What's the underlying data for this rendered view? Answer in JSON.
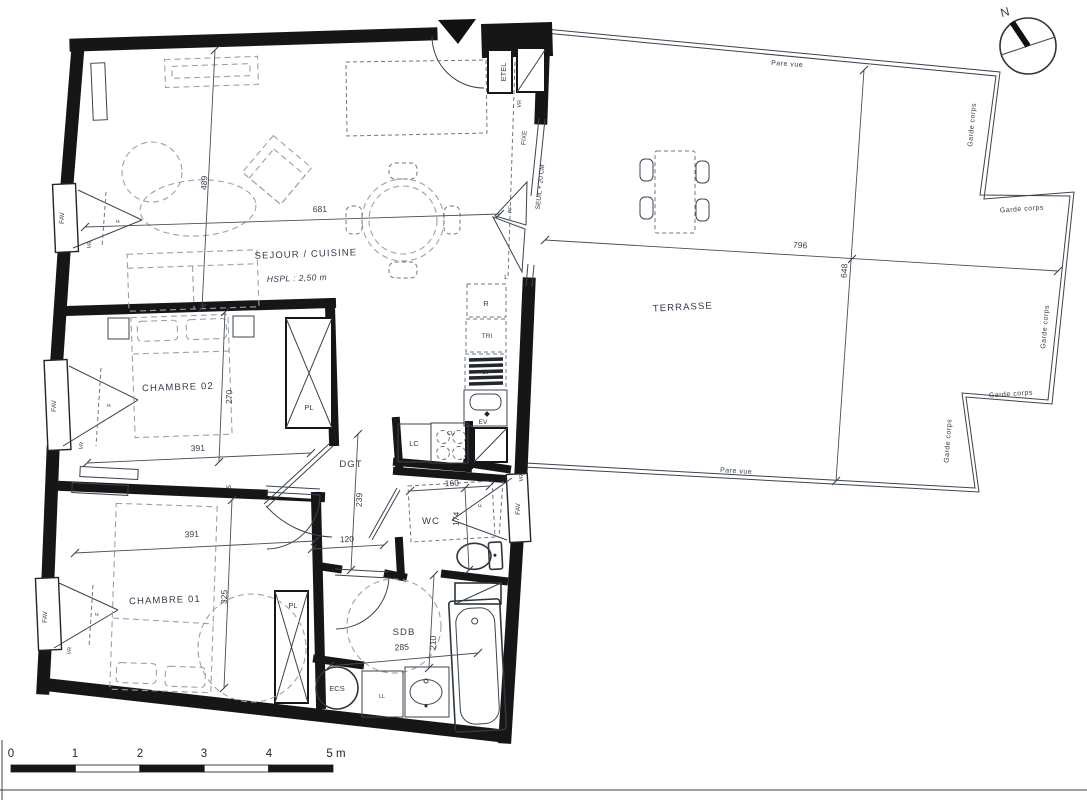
{
  "rooms": {
    "sejour": {
      "label": "SEJOUR / CUISINE",
      "hspl": "HSPL : 2,50 m"
    },
    "chambre02": {
      "label": "CHAMBRE 02"
    },
    "chambre01": {
      "label": "CHAMBRE 01"
    },
    "terrasse": {
      "label": "TERRASSE"
    },
    "dgt": {
      "label": "DGT"
    },
    "wc": {
      "label": "WC"
    },
    "sdb": {
      "label": "SDB"
    }
  },
  "fixtures": {
    "etel": "ETEL",
    "refrigerateur": "R",
    "tri": "TRI",
    "lave_vaisselle": "LV",
    "evier": "EV",
    "lave_linge_cuisine": "LC",
    "cuisson": "CU",
    "l": "L",
    "placard_haut": "PL",
    "placard_bas": "PL",
    "ecs": "ECS",
    "lave_linge": "LL"
  },
  "openings": {
    "fav": "FAV",
    "fixe": "FIXE",
    "pf": "PF",
    "vr": "VR",
    "f": "F",
    "seuil": "SEUIL + 20 CM"
  },
  "dimensions": {
    "sejour_longueur": "681",
    "sejour_largeur": "489",
    "chambre02_longueur": "391",
    "chambre02_largeur": "270",
    "chambre01_longueur": "391",
    "chambre01_largeur": "325",
    "cloison": "5",
    "dgt_longueur": "239",
    "dgt_largeur": "120",
    "wc_longueur": "160",
    "wc_largeur": "174",
    "sdb_longueur": "285",
    "sdb_largeur": "210",
    "terrasse_longueur": "796",
    "terrasse_largeur": "648"
  },
  "terrasse_annotations": {
    "pare_vue_haut": "Pare vue",
    "pare_vue_bas": "Pare vue",
    "garde_corps": "Garde corps"
  },
  "compass": {
    "north": "N"
  },
  "scale_bar": {
    "labels": [
      "0",
      "1",
      "2",
      "3",
      "4",
      "5 m"
    ]
  },
  "colors": {
    "wall": "#161616",
    "line": "#3c434e",
    "text": "#343b47",
    "dash": "#9aa1ab"
  }
}
